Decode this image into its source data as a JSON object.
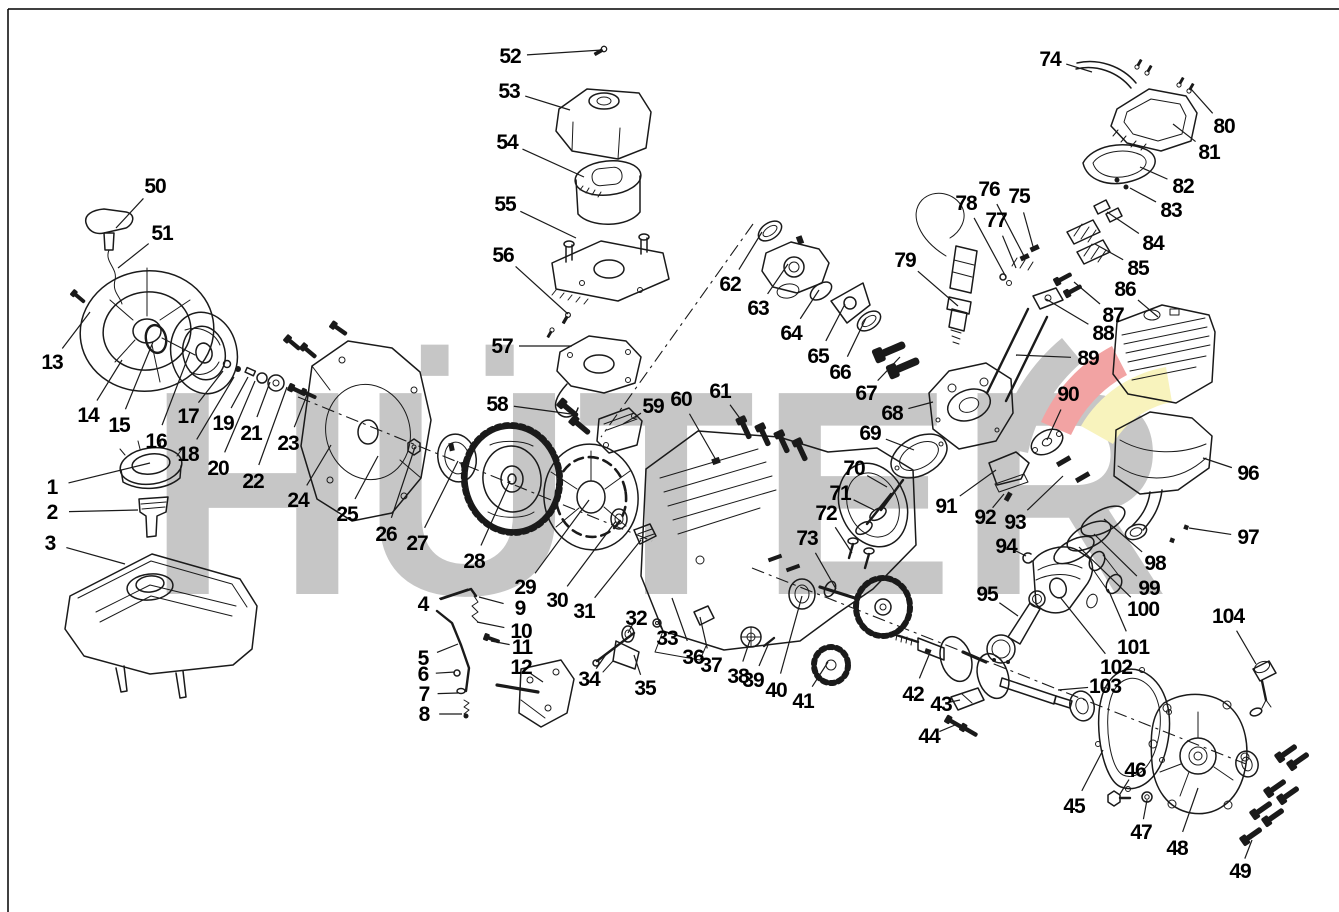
{
  "page": {
    "background": "#ffffff",
    "line_color": "#1a1a1a"
  },
  "watermark": {
    "text": "HÜTER",
    "letters_color": "#c6c6c6",
    "swoosh_gray": "#c6c6c6",
    "swoosh_red": "#f2a3a3",
    "swoosh_yellow": "#f8f3bd"
  },
  "diagram": {
    "part_count": 104
  },
  "labels": [
    {
      "n": 1,
      "x": 52,
      "y": 487,
      "px": 150,
      "py": 463
    },
    {
      "n": 2,
      "x": 52,
      "y": 512,
      "px": 138,
      "py": 510
    },
    {
      "n": 3,
      "x": 50,
      "y": 543,
      "px": 125,
      "py": 564
    },
    {
      "n": 4,
      "x": 423,
      "y": 604,
      "px": 468,
      "py": 589
    },
    {
      "n": 5,
      "x": 423,
      "y": 658,
      "px": 458,
      "py": 644
    },
    {
      "n": 6,
      "x": 423,
      "y": 674,
      "px": 455,
      "py": 672
    },
    {
      "n": 7,
      "x": 424,
      "y": 694,
      "px": 458,
      "py": 693
    },
    {
      "n": 8,
      "x": 424,
      "y": 714,
      "px": 462,
      "py": 714
    },
    {
      "n": 9,
      "x": 520,
      "y": 608,
      "px": 479,
      "py": 597
    },
    {
      "n": 10,
      "x": 521,
      "y": 631,
      "px": 477,
      "py": 622
    },
    {
      "n": 11,
      "x": 522,
      "y": 647,
      "px": 491,
      "py": 641
    },
    {
      "n": 12,
      "x": 521,
      "y": 667,
      "px": 543,
      "py": 682
    },
    {
      "n": 13,
      "x": 52,
      "y": 362,
      "px": 90,
      "py": 312
    },
    {
      "n": 14,
      "x": 88,
      "y": 415,
      "px": 122,
      "py": 360
    },
    {
      "n": 15,
      "x": 119,
      "y": 425,
      "px": 153,
      "py": 342
    },
    {
      "n": 16,
      "x": 156,
      "y": 441,
      "px": 190,
      "py": 352
    },
    {
      "n": 17,
      "x": 188,
      "y": 416,
      "px": 223,
      "py": 371
    },
    {
      "n": 18,
      "x": 188,
      "y": 454,
      "px": 234,
      "py": 377
    },
    {
      "n": 19,
      "x": 223,
      "y": 423,
      "px": 248,
      "py": 377
    },
    {
      "n": 20,
      "x": 218,
      "y": 468,
      "px": 255,
      "py": 381
    },
    {
      "n": 21,
      "x": 251,
      "y": 433,
      "px": 270,
      "py": 382
    },
    {
      "n": 22,
      "x": 253,
      "y": 481,
      "px": 287,
      "py": 387
    },
    {
      "n": 23,
      "x": 288,
      "y": 443,
      "px": 309,
      "py": 390
    },
    {
      "n": 24,
      "x": 298,
      "y": 500,
      "px": 331,
      "py": 445
    },
    {
      "n": 25,
      "x": 347,
      "y": 514,
      "px": 378,
      "py": 456
    },
    {
      "n": 26,
      "x": 386,
      "y": 534,
      "px": 415,
      "py": 447
    },
    {
      "n": 27,
      "x": 417,
      "y": 543,
      "px": 458,
      "py": 461
    },
    {
      "n": 28,
      "x": 474,
      "y": 561,
      "px": 510,
      "py": 481
    },
    {
      "n": 29,
      "x": 525,
      "y": 587,
      "px": 589,
      "py": 500
    },
    {
      "n": 30,
      "x": 557,
      "y": 600,
      "px": 616,
      "py": 521
    },
    {
      "n": 31,
      "x": 584,
      "y": 611,
      "px": 641,
      "py": 540
    },
    {
      "n": 32,
      "x": 636,
      "y": 618,
      "px": 628,
      "py": 633
    },
    {
      "n": 33,
      "x": 667,
      "y": 638,
      "px": 658,
      "py": 622
    },
    {
      "n": 34,
      "x": 589,
      "y": 679,
      "px": 607,
      "py": 653
    },
    {
      "n": 35,
      "x": 645,
      "y": 688,
      "px": 634,
      "py": 655
    },
    {
      "n": 36,
      "x": 693,
      "y": 657,
      "px": 672,
      "py": 598
    },
    {
      "n": 37,
      "x": 711,
      "y": 665,
      "px": 700,
      "py": 617
    },
    {
      "n": 38,
      "x": 738,
      "y": 676,
      "px": 750,
      "py": 640
    },
    {
      "n": 39,
      "x": 753,
      "y": 680,
      "px": 768,
      "py": 645
    },
    {
      "n": 40,
      "x": 776,
      "y": 690,
      "px": 802,
      "py": 596
    },
    {
      "n": 41,
      "x": 803,
      "y": 701,
      "px": 828,
      "py": 662
    },
    {
      "n": 42,
      "x": 913,
      "y": 694,
      "px": 929,
      "py": 655
    },
    {
      "n": 43,
      "x": 941,
      "y": 704,
      "px": 960,
      "py": 700
    },
    {
      "n": 44,
      "x": 929,
      "y": 736,
      "px": 955,
      "py": 725
    },
    {
      "n": 45,
      "x": 1074,
      "y": 806,
      "px": 1103,
      "py": 750
    },
    {
      "n": 46,
      "x": 1135,
      "y": 770,
      "px": 1120,
      "py": 794
    },
    {
      "n": 47,
      "x": 1141,
      "y": 832,
      "px": 1147,
      "py": 800
    },
    {
      "n": 48,
      "x": 1177,
      "y": 848,
      "px": 1198,
      "py": 788
    },
    {
      "n": 49,
      "x": 1240,
      "y": 871,
      "px": 1252,
      "py": 840
    },
    {
      "n": 50,
      "x": 155,
      "y": 186,
      "px": 116,
      "py": 228
    },
    {
      "n": 51,
      "x": 162,
      "y": 233,
      "px": 118,
      "py": 268
    },
    {
      "n": 52,
      "x": 510,
      "y": 56,
      "px": 602,
      "py": 50
    },
    {
      "n": 53,
      "x": 509,
      "y": 91,
      "px": 570,
      "py": 110
    },
    {
      "n": 54,
      "x": 507,
      "y": 142,
      "px": 584,
      "py": 177
    },
    {
      "n": 55,
      "x": 505,
      "y": 204,
      "px": 576,
      "py": 238
    },
    {
      "n": 56,
      "x": 503,
      "y": 255,
      "px": 568,
      "py": 314
    },
    {
      "n": 57,
      "x": 502,
      "y": 346,
      "px": 572,
      "py": 346
    },
    {
      "n": 58,
      "x": 497,
      "y": 404,
      "px": 571,
      "py": 414
    },
    {
      "n": 59,
      "x": 653,
      "y": 406,
      "px": 623,
      "py": 424
    },
    {
      "n": 60,
      "x": 681,
      "y": 399,
      "px": 716,
      "py": 460
    },
    {
      "n": 61,
      "x": 720,
      "y": 391,
      "px": 747,
      "py": 428
    },
    {
      "n": 62,
      "x": 730,
      "y": 284,
      "px": 762,
      "py": 232
    },
    {
      "n": 63,
      "x": 758,
      "y": 308,
      "px": 788,
      "py": 264
    },
    {
      "n": 64,
      "x": 791,
      "y": 333,
      "px": 819,
      "py": 290
    },
    {
      "n": 65,
      "x": 818,
      "y": 356,
      "px": 845,
      "py": 304
    },
    {
      "n": 66,
      "x": 840,
      "y": 372,
      "px": 866,
      "py": 318
    },
    {
      "n": 67,
      "x": 866,
      "y": 393,
      "px": 900,
      "py": 357
    },
    {
      "n": 68,
      "x": 892,
      "y": 413,
      "px": 933,
      "py": 402
    },
    {
      "n": 69,
      "x": 870,
      "y": 433,
      "px": 914,
      "py": 450
    },
    {
      "n": 70,
      "x": 854,
      "y": 468,
      "px": 887,
      "py": 487
    },
    {
      "n": 71,
      "x": 840,
      "y": 493,
      "px": 874,
      "py": 510
    },
    {
      "n": 72,
      "x": 826,
      "y": 513,
      "px": 852,
      "py": 553
    },
    {
      "n": 73,
      "x": 807,
      "y": 538,
      "px": 836,
      "py": 589
    },
    {
      "n": 74,
      "x": 1050,
      "y": 59,
      "px": 1092,
      "py": 72
    },
    {
      "n": 75,
      "x": 1019,
      "y": 196,
      "px": 1034,
      "py": 250
    },
    {
      "n": 76,
      "x": 989,
      "y": 189,
      "px": 1025,
      "py": 258
    },
    {
      "n": 77,
      "x": 996,
      "y": 220,
      "px": 1016,
      "py": 268
    },
    {
      "n": 78,
      "x": 966,
      "y": 203,
      "px": 1006,
      "py": 277
    },
    {
      "n": 79,
      "x": 905,
      "y": 260,
      "px": 958,
      "py": 306
    },
    {
      "n": 80,
      "x": 1224,
      "y": 126,
      "px": 1191,
      "py": 89
    },
    {
      "n": 81,
      "x": 1209,
      "y": 152,
      "px": 1173,
      "py": 124
    },
    {
      "n": 82,
      "x": 1183,
      "y": 186,
      "px": 1140,
      "py": 167
    },
    {
      "n": 83,
      "x": 1171,
      "y": 210,
      "px": 1130,
      "py": 188
    },
    {
      "n": 84,
      "x": 1153,
      "y": 243,
      "px": 1107,
      "py": 212
    },
    {
      "n": 85,
      "x": 1138,
      "y": 268,
      "px": 1095,
      "py": 244
    },
    {
      "n": 86,
      "x": 1125,
      "y": 289,
      "px": 1158,
      "py": 317
    },
    {
      "n": 87,
      "x": 1113,
      "y": 315,
      "px": 1074,
      "py": 282
    },
    {
      "n": 88,
      "x": 1103,
      "y": 333,
      "px": 1046,
      "py": 299
    },
    {
      "n": 89,
      "x": 1088,
      "y": 358,
      "px": 1016,
      "py": 355
    },
    {
      "n": 90,
      "x": 1068,
      "y": 394,
      "px": 1047,
      "py": 440
    },
    {
      "n": 91,
      "x": 946,
      "y": 506,
      "px": 996,
      "py": 470
    },
    {
      "n": 92,
      "x": 985,
      "y": 517,
      "px": 1004,
      "py": 494
    },
    {
      "n": 93,
      "x": 1015,
      "y": 522,
      "px": 1063,
      "py": 476
    },
    {
      "n": 94,
      "x": 1006,
      "y": 546,
      "px": 1026,
      "py": 556
    },
    {
      "n": 95,
      "x": 987,
      "y": 594,
      "px": 1018,
      "py": 616
    },
    {
      "n": 96,
      "x": 1248,
      "y": 473,
      "px": 1203,
      "py": 458
    },
    {
      "n": 97,
      "x": 1248,
      "y": 537,
      "px": 1189,
      "py": 528
    },
    {
      "n": 98,
      "x": 1155,
      "y": 563,
      "px": 1104,
      "py": 519
    },
    {
      "n": 99,
      "x": 1149,
      "y": 588,
      "px": 1094,
      "py": 534
    },
    {
      "n": 100,
      "x": 1143,
      "y": 609,
      "px": 1079,
      "py": 547
    },
    {
      "n": 101,
      "x": 1133,
      "y": 647,
      "px": 1108,
      "py": 589
    },
    {
      "n": 102,
      "x": 1116,
      "y": 667,
      "px": 1060,
      "py": 597
    },
    {
      "n": 103,
      "x": 1105,
      "y": 686,
      "px": 1058,
      "py": 690
    },
    {
      "n": 104,
      "x": 1228,
      "y": 616,
      "px": 1256,
      "py": 664
    }
  ]
}
